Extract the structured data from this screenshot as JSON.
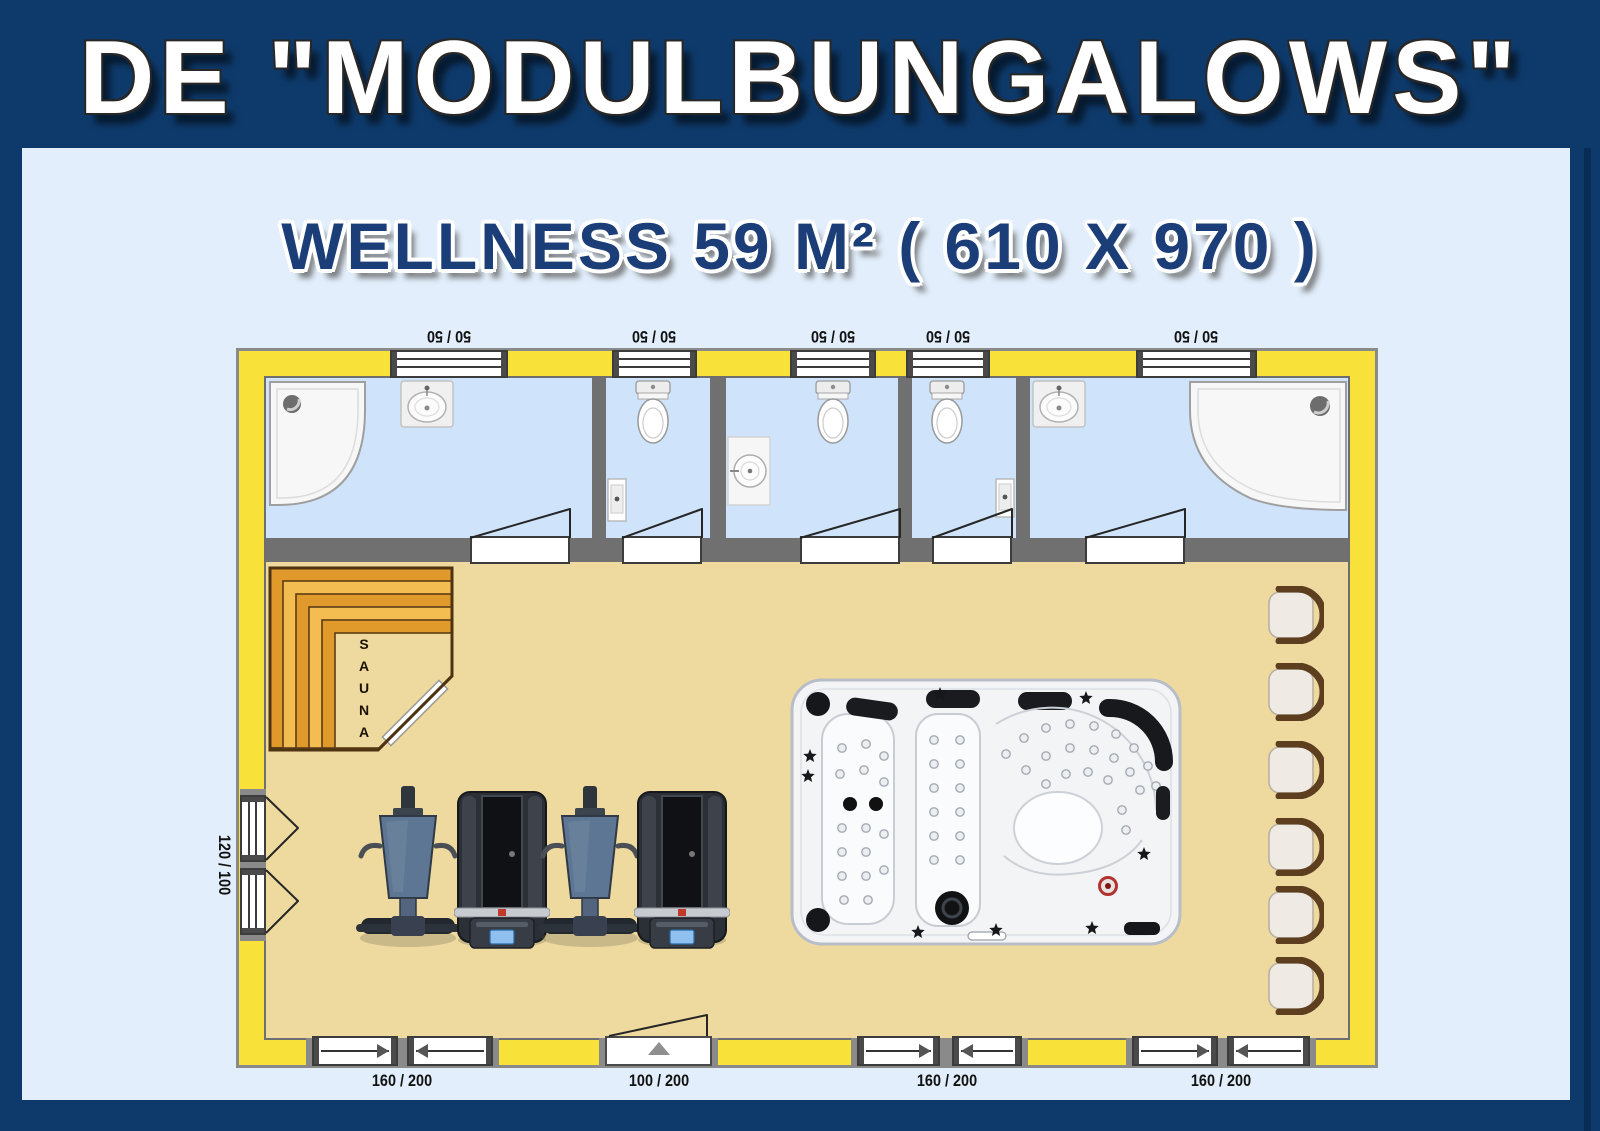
{
  "banner": {
    "title": "DE \"MODULBUNGALOWS\""
  },
  "subtitle": "WELLNESS 59 M² ( 610 X 970 )",
  "plan": {
    "sauna_label": "SAUNA",
    "top_window_labels": [
      "50 / 50",
      "50 / 50",
      "50 / 50",
      "50 / 50",
      "50 / 50"
    ],
    "left_window_label": "120 / 100",
    "bottom_opening_labels": [
      "160 / 200",
      "100 / 200",
      "160 / 200",
      "160 / 200"
    ],
    "rooms": [
      "shower-room-left",
      "wc-1",
      "wc-2",
      "wc-3",
      "shower-room-right",
      "wellness-hall"
    ],
    "equipment": [
      "corner-shower",
      "washbasin",
      "toilet",
      "sauna",
      "fitness-machine",
      "treadmill",
      "spa-whirlpool",
      "chair"
    ],
    "colors": {
      "frame_navy": "#0e3a6b",
      "banner_navy": "#113e74",
      "background_blue": "#e2eefb",
      "wall_yellow": "#f8e23a",
      "wall_gray": "#707070",
      "bathroom_floor_blue": "#cfe4fb",
      "hall_floor_tan": "#eeda9f",
      "sauna_orange": "#e09a2c",
      "sauna_orange_light": "#f3bd52",
      "title_white": "#ffffff",
      "subtitle_navy": "#1b3e78"
    }
  }
}
